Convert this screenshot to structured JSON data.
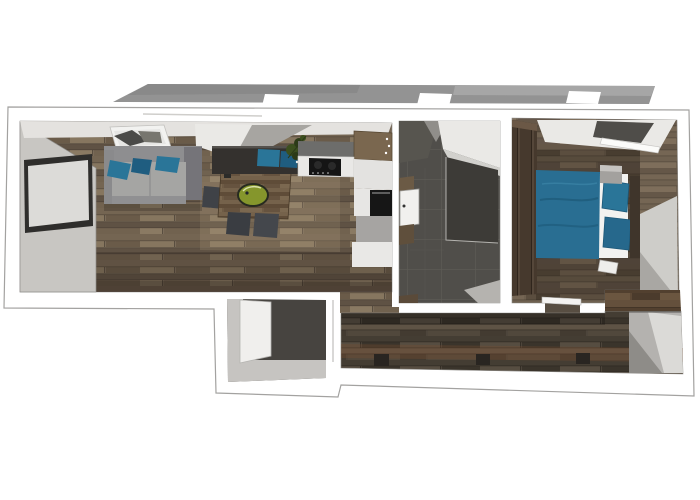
{
  "scene": {
    "type": "3d-floor-plan-top-down-render",
    "description": "Photorealistic top-down 3D render of a one-bedroom apartment with open living/kitchen area, bathroom, bedroom, hallway and entry vestibule; gray roof canopy band along the top",
    "rooms": [
      {
        "name": "living-room-kitchen",
        "furniture": [
          "wall-art",
          "gray-sofa-with-teal-pillows",
          "dining-table",
          "green-bowl",
          "dining-chairs",
          "dark-sideboard-bench-with-teal-cushions",
          "plant",
          "kitchen-upper-cabinets",
          "wood-tall-cabinet",
          "kitchen-counter",
          "black-cooktop",
          "black-oven",
          "left-wall-window-panel"
        ]
      },
      {
        "name": "bathroom",
        "furniture": [
          "white-door",
          "dark-tiled-shower",
          "wood-shelves"
        ]
      },
      {
        "name": "bedroom",
        "furniture": [
          "teal-double-bed",
          "white-sheets",
          "teal-pillows",
          "wood-wardrobe",
          "nightstand",
          "window-strip",
          "open-door-leaf",
          "foot-bench"
        ]
      },
      {
        "name": "hallway",
        "furniture": [
          "door-mats",
          "wood-sideboard-niche",
          "gray-wardrobe"
        ]
      },
      {
        "name": "entry-vestibule",
        "furniture": [
          "white-entry-door",
          "dark-tile-floor"
        ]
      }
    ],
    "roof_canopy": "gray canopy band with three white skylight notches"
  },
  "palette": {
    "background": "#ffffff",
    "canopy_gray": "#939393",
    "canopy_light": "#a6a6a6",
    "canopy_dark": "#898989",
    "wall_white": "#ffffff",
    "outline_gray": "#a3a2a0",
    "wall_face_gray": "#c8c6c2",
    "wall_face_white": "#eae9e6",
    "floor_living_base": "#7b6c5a",
    "floor_hall_base": "#4d453b",
    "floor_bed_base": "#6d5f4e",
    "floor_bath": "#504e4a",
    "shower_dark": "#3d3b37",
    "sofa_gray": "#a5a5a3",
    "sofa_back_gray": "#8e8e90",
    "sofa_arm_gray": "#757479",
    "accent_teal": "#2a7598",
    "accent_teal_dark": "#1f5d80",
    "bed_duvet_teal": "#296e92",
    "bed_sheet_white": "#f2f2f0",
    "headboard_wood": "#3f352b",
    "wardrobe_wood": "#46392d",
    "niche_wood": "#5d4936",
    "table_wood": "#6e5b45",
    "chair_dark": "#3f4247",
    "bench_dark": "#34312e",
    "bowl_green": "#85962c",
    "plant_green": "#3c4f1e",
    "counter_white": "#e9e8e6",
    "cabinet_gray": "#6d6d6b",
    "cabinet_wood": "#7a674f",
    "cooktop_black": "#151515",
    "door_white": "#f0efed",
    "mat_dark": "#292521",
    "art_frame": "#f2f2f0",
    "art_dark": "#4a4a48",
    "window_white": "#fbfbf9",
    "nightstand_gray": "#a3a19e",
    "wardrobe_front_light": "#dbdad7",
    "wardrobe_front_mid": "#b4b2af",
    "wardrobe_front_dark": "#8e8c88",
    "vestibule_gray": "#c6c4c1",
    "tile_dark": "#474440"
  }
}
